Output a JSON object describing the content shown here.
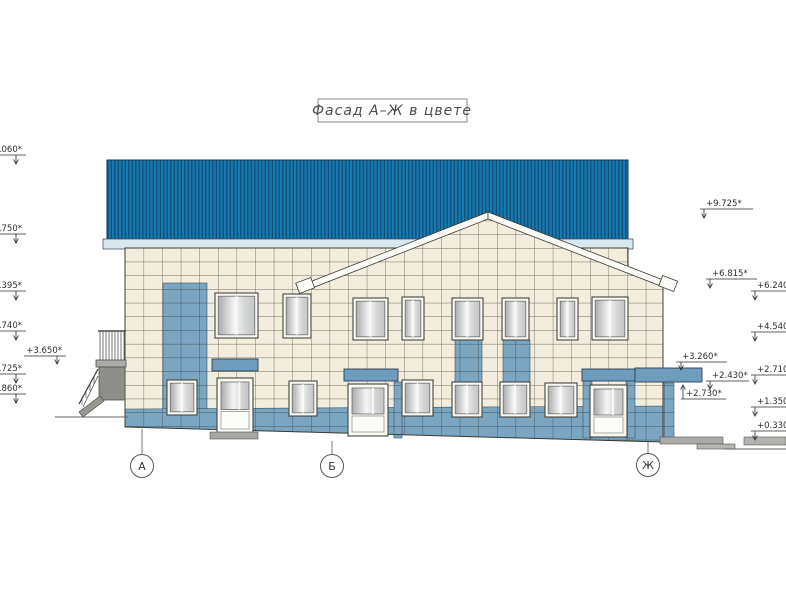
{
  "title": "Фасад А–Ж в цвете",
  "axes": [
    {
      "label": "А"
    },
    {
      "label": "Б"
    },
    {
      "label": "Ж"
    }
  ],
  "elevation_marks": {
    "left": [
      ".060*",
      ".750*",
      ".395*",
      ".740*",
      "+3.650*",
      ".725*",
      ".860*"
    ],
    "right_inner": [
      "+9.725*",
      "+6.815*",
      "+3.260*",
      "+2.430*",
      "+2.730*"
    ],
    "right_outer": [
      "+6.240*",
      "+4.540*",
      "+2.710*",
      "+1.350*",
      "+0.330*"
    ]
  },
  "palette": {
    "roof_blue": "#1879af",
    "roof_stripe": "#0e4e77",
    "fascia_light": "#d9e7ef",
    "tile_cream": "#f2eddc",
    "tile_blue": "#7ba6c2",
    "canopy_blue": "#6d9cbd",
    "outline": "#3c3c34"
  }
}
